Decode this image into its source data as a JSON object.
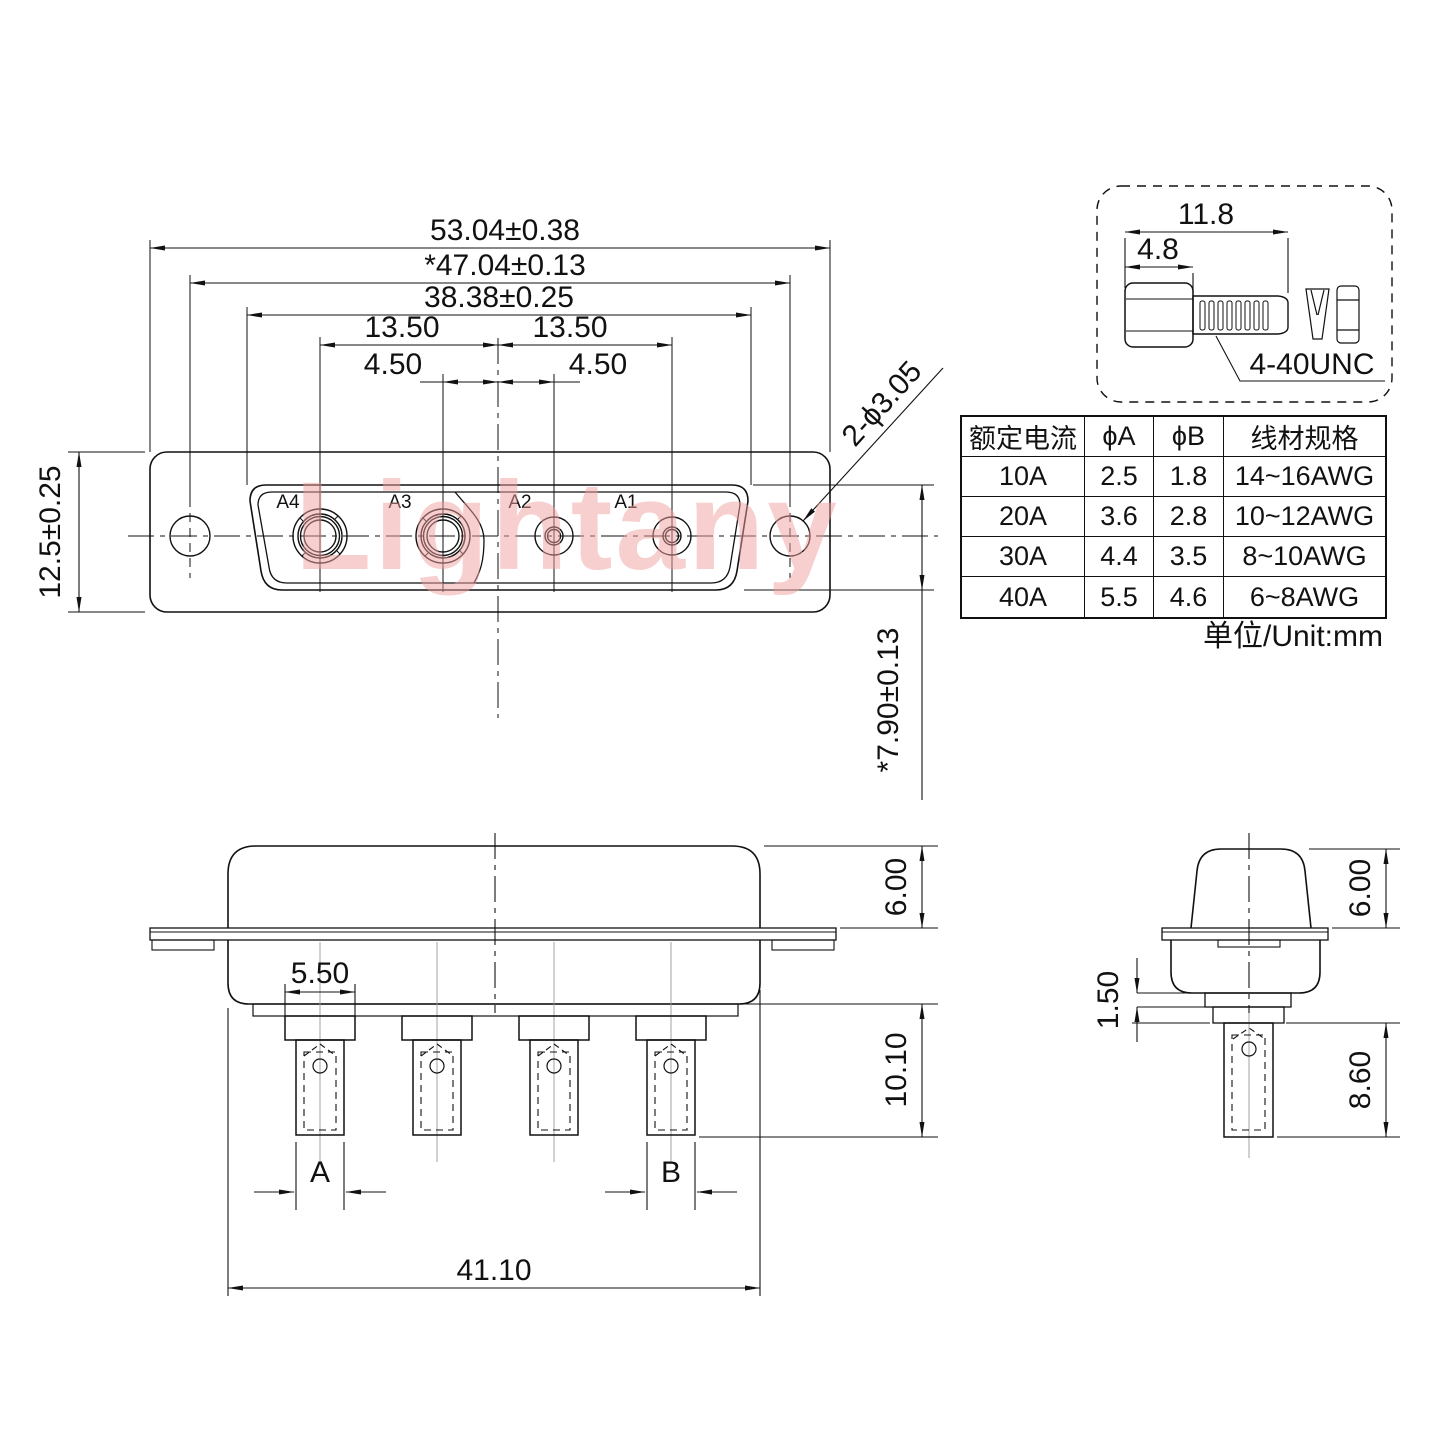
{
  "watermark": "Lightany",
  "front_view": {
    "contact_labels": [
      "A4",
      "A3",
      "A2",
      "A1"
    ],
    "dims": {
      "overall_width": "53.04±0.38",
      "mount_span": "*47.04±0.13",
      "shell_width": "38.38±0.25",
      "pitch_outer_left": "13.50",
      "pitch_outer_right": "13.50",
      "pitch_inner_left": "4.50",
      "pitch_inner_right": "4.50",
      "flange_height": "12.5±0.25",
      "opening_height": "*7.90±0.13",
      "mount_hole_callout": "2-ϕ3.05"
    }
  },
  "screw_detail": {
    "overall_length": "11.8",
    "head_length": "4.8",
    "thread_spec": "4-40UNC"
  },
  "spec_table": {
    "headers": [
      "额定电流",
      "ϕA",
      "ϕB",
      "线材规格"
    ],
    "rows": [
      [
        "10A",
        "2.5",
        "1.8",
        "14~16AWG"
      ],
      [
        "20A",
        "3.6",
        "2.8",
        "10~12AWG"
      ],
      [
        "30A",
        "4.4",
        "3.5",
        "8~10AWG"
      ],
      [
        "40A",
        "5.5",
        "4.6",
        "6~8AWG"
      ]
    ],
    "unit_note": "单位/Unit:mm"
  },
  "side_view": {
    "dims": {
      "shell_height": "6.00",
      "shoulder_width": "5.50",
      "pin_length": "10.10",
      "overall_width": "41.10"
    },
    "pin_section_labels": {
      "a": "A",
      "b": "B"
    }
  },
  "end_view": {
    "dims": {
      "shell_height": "6.00",
      "step_height": "1.50",
      "pin_length": "8.60"
    }
  }
}
